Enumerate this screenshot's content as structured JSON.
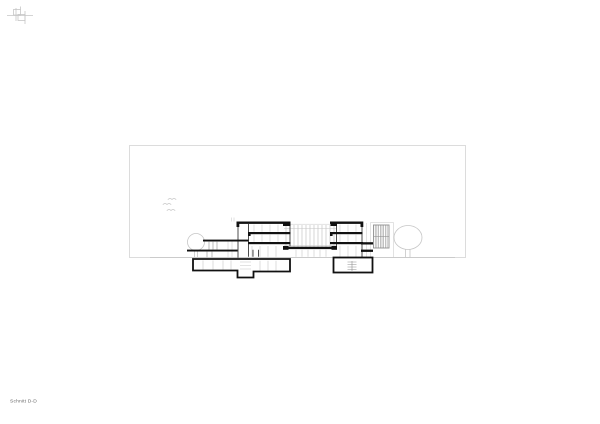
{
  "sheet": {
    "title": "Schnitt D-D"
  },
  "palette": {
    "paper": "#ffffff",
    "frame": "#dcdcdc",
    "light_line": "#c6c6c6",
    "mid_line": "#8f8f8f",
    "dark_line": "#3a3a3a",
    "cut_black": "#111111",
    "text": "#6a6a6a"
  }
}
